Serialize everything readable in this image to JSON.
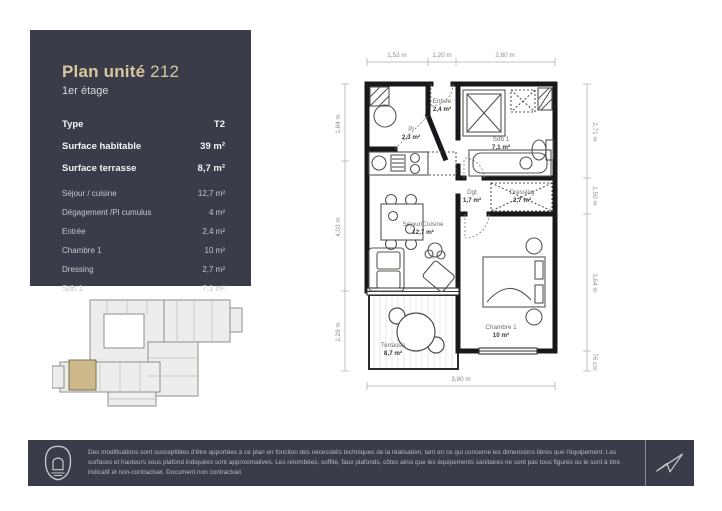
{
  "colors": {
    "panel": "#3a3d49",
    "accent_gold": "#d8c69d",
    "highlight_unit": "#cdb98c",
    "plan_line": "#17171c",
    "dim_line": "#b0b0ab"
  },
  "header": {
    "title": "Plan unité",
    "unit_number": "212",
    "floor": "1er étage"
  },
  "summary": {
    "rows": [
      {
        "label": "Type",
        "value": "T2"
      },
      {
        "label": "Surface habitable",
        "value": "39 m²"
      },
      {
        "label": "Surface terrasse",
        "value": "8,7 m²"
      }
    ]
  },
  "room_table": {
    "rows": [
      {
        "label": "Séjour / cuisine",
        "value": "12,7 m²"
      },
      {
        "label": "Dégagement /Pl cumulus",
        "value": "4 m²"
      },
      {
        "label": "Entrée",
        "value": "2,4 m²"
      },
      {
        "label": "Chambre 1",
        "value": "10 m²"
      },
      {
        "label": "Dressing",
        "value": "2,7 m²"
      },
      {
        "label": "Sdb 1",
        "value": "7,1 m²"
      }
    ]
  },
  "floor_plan": {
    "rooms": {
      "pl": {
        "name": "Pl",
        "area": "2,3 m²"
      },
      "entree": {
        "name": "Entrée",
        "area": "2,4 m²"
      },
      "sdb": {
        "name": "Sdb 1",
        "area": "7,1 m²"
      },
      "dgt": {
        "name": "Dgt",
        "area": "1,7 m²"
      },
      "dressing": {
        "name": "Dressing",
        "area": "2,7 m²"
      },
      "sejour": {
        "name": "Séjour/Cuisine",
        "area": "12,7 m²"
      },
      "chambre": {
        "name": "Chambre 1",
        "area": "10 m²"
      },
      "terrasse": {
        "name": "Terrasse",
        "area": "8,7 m²"
      }
    },
    "dimensions": {
      "top": [
        "1,52 m",
        "1,20 m",
        "2,80 m"
      ],
      "left": [
        "1,84 m",
        "4,03 m",
        "2,28 m"
      ],
      "right": [
        "2,71 m",
        "1,50 m",
        "3,64 m",
        "76 cm"
      ],
      "bottom": [
        "3,80 m"
      ]
    }
  },
  "footer": {
    "disclaimer": "Des modifications sont susceptibles d'être apportées à ce plan en fonction des nécessités techniques de la réalisation, tant en ce qui concerne les dimensions libres que l'équipement. Les surfaces et hauteurs sous plafond indiquées sont approximatives. Les retombées, soffite, faux plafonds, côtes ainsi que les équipements sanitaires ne sont pas tous figurés ou le sont à titre indicatif et non-contractuel. Document non contractuel."
  }
}
